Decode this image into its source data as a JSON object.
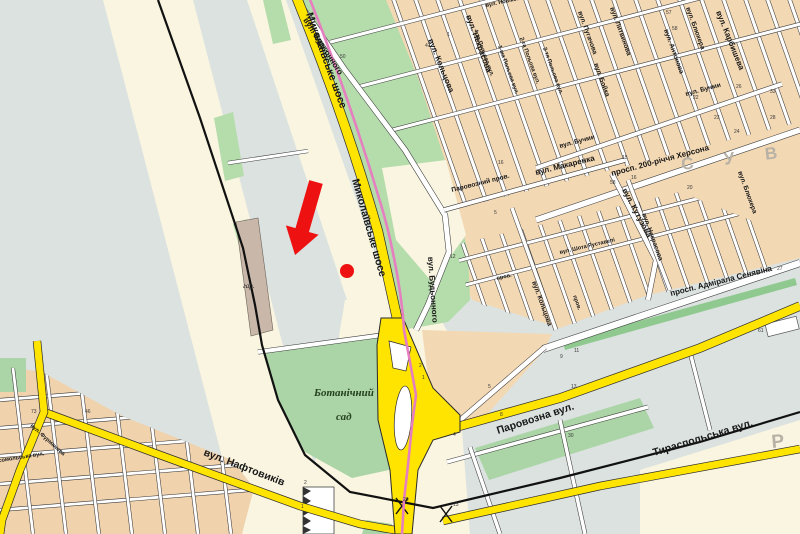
{
  "map": {
    "district_name_partial": "С У В О Р",
    "district_letter_bottom_right": "Р",
    "garden_name": [
      "Ботанічний",
      "сад"
    ],
    "marker": {
      "shape": "red-arrow-with-dot",
      "color": "#ee1111",
      "target": "Миколаївське шосе"
    },
    "colors": {
      "land_gray": "#dbe2e0",
      "land_cream": "#f9f5e0",
      "blocks_peach": "#f3d8b4",
      "park_green": "#b5dcab",
      "garden_green": "#abd5a6",
      "strip_green": "#8fc98f",
      "industrial_brown": "#c9b7aa",
      "road_yellow": "#ffe400",
      "route_pink": "#e57fc0",
      "railway_black": "#111111",
      "marker_red": "#ee1111"
    },
    "labels": [
      {
        "t": "Миколаївське шосе",
        "x": 306,
        "y": 14,
        "r": 70,
        "c": "rb"
      },
      {
        "t": "Миколаївське шосе",
        "x": 352,
        "y": 180,
        "r": 74,
        "c": "rb"
      },
      {
        "t": "Паровозна вул.",
        "x": 498,
        "y": 434,
        "r": -18,
        "c": "rb"
      },
      {
        "t": "Тираспольська вул.",
        "x": 654,
        "y": 456,
        "r": -17,
        "c": "rb"
      },
      {
        "t": "вул. Нафтовиків",
        "x": 203,
        "y": 455,
        "r": 21,
        "c": "rb"
      },
      {
        "t": "вул. Будьонного",
        "x": 303,
        "y": 20,
        "r": 57,
        "c": "md"
      },
      {
        "t": "вул. Будьонного",
        "x": 428,
        "y": 257,
        "r": 86,
        "c": "md"
      },
      {
        "t": "просп. Адмірала Сенявіна",
        "x": 671,
        "y": 296,
        "r": -14,
        "c": "md"
      },
      {
        "t": "просп. 200-річчя Херсона",
        "x": 612,
        "y": 176,
        "r": -15,
        "c": "md"
      },
      {
        "t": "вул. Карбишева",
        "x": 716,
        "y": 12,
        "r": 68,
        "c": "md"
      },
      {
        "t": "вул. Кутузова",
        "x": 622,
        "y": 190,
        "r": 62,
        "c": "md"
      },
      {
        "t": "вул. Макаренка",
        "x": 536,
        "y": 175,
        "r": -14,
        "c": "md"
      },
      {
        "t": "вул. Некрасова",
        "x": 466,
        "y": 16,
        "r": 70,
        "c": "md"
      },
      {
        "t": "вул. Некрасова",
        "x": 642,
        "y": 214,
        "r": 70,
        "c": "st"
      },
      {
        "t": "вул. Кольцова",
        "x": 428,
        "y": 40,
        "r": 68,
        "c": "md"
      },
      {
        "t": "вул. Кольцова",
        "x": 532,
        "y": 282,
        "r": 70,
        "c": "st"
      },
      {
        "t": "вул. Бойка",
        "x": 594,
        "y": 64,
        "r": 70,
        "c": "st"
      },
      {
        "t": "вул. Блюхера",
        "x": 686,
        "y": 8,
        "r": 70,
        "c": "st"
      },
      {
        "t": "вул. Блюхера",
        "x": 738,
        "y": 172,
        "r": 70,
        "c": "st"
      },
      {
        "t": "вул. Антонова",
        "x": 664,
        "y": 30,
        "r": 70,
        "c": "st"
      },
      {
        "t": "вул. Бучми",
        "x": 686,
        "y": 96,
        "r": -15,
        "c": "st"
      },
      {
        "t": "вул. Бучми",
        "x": 560,
        "y": 148,
        "r": -15,
        "c": "st"
      },
      {
        "t": "4-та Польова вул.",
        "x": 474,
        "y": 30,
        "r": 70,
        "c": "sm"
      },
      {
        "t": "1-ша Польова вул.",
        "x": 498,
        "y": 46,
        "r": 70,
        "c": "sm"
      },
      {
        "t": "2-га Польова вул.",
        "x": 520,
        "y": 38,
        "r": 70,
        "c": "sm"
      },
      {
        "t": "3-тя Польова вул.",
        "x": 543,
        "y": 48,
        "r": 70,
        "c": "sm"
      },
      {
        "t": "вул. Пугачова",
        "x": 578,
        "y": 12,
        "r": 70,
        "c": "st"
      },
      {
        "t": "вул. Литвинова",
        "x": 610,
        "y": 8,
        "r": 70,
        "c": "st"
      },
      {
        "t": "вул. Новікова",
        "x": 486,
        "y": 7,
        "r": -12,
        "c": "sm"
      },
      {
        "t": "Паровозний пров.",
        "x": 452,
        "y": 192,
        "r": -14,
        "c": "st"
      },
      {
        "t": "вул. Шота Руставелі",
        "x": 560,
        "y": 254,
        "r": -13,
        "c": "sm"
      },
      {
        "t": "пров.",
        "x": 497,
        "y": 280,
        "r": -13,
        "c": "sm"
      },
      {
        "t": "пров.",
        "x": 573,
        "y": 296,
        "r": 70,
        "c": "sm"
      },
      {
        "t": "Комсомольська вул.",
        "x": -12,
        "y": 464,
        "r": -9,
        "c": "sm"
      },
      {
        "t": "вул. Фурманова",
        "x": 30,
        "y": 426,
        "r": 42,
        "c": "sm"
      },
      {
        "t": "Ботанічний",
        "x": 314,
        "y": 396,
        "r": 0,
        "c": "gard"
      },
      {
        "t": "сад",
        "x": 336,
        "y": 420,
        "r": 0,
        "c": "gard"
      },
      {
        "t": "гар.",
        "x": 243,
        "y": 288,
        "r": 0,
        "c": "gari"
      },
      {
        "t": "С У В О Р",
        "x": 682,
        "y": 170,
        "r": -7,
        "c": "dist"
      },
      {
        "t": "Р",
        "x": 772,
        "y": 448,
        "r": -5,
        "c": "dist2"
      }
    ],
    "house_numbers": [
      {
        "t": "50",
        "x": 340,
        "y": 58
      },
      {
        "t": "47",
        "x": 425,
        "y": 47
      },
      {
        "t": "1",
        "x": 447,
        "y": 36
      },
      {
        "t": "12",
        "x": 450,
        "y": 258
      },
      {
        "t": "16",
        "x": 498,
        "y": 164
      },
      {
        "t": "5",
        "x": 494,
        "y": 214
      },
      {
        "t": "57",
        "x": 666,
        "y": 14
      },
      {
        "t": "58",
        "x": 672,
        "y": 30
      },
      {
        "t": "26",
        "x": 736,
        "y": 88
      },
      {
        "t": "33",
        "x": 770,
        "y": 93
      },
      {
        "t": "22",
        "x": 693,
        "y": 99
      },
      {
        "t": "23",
        "x": 714,
        "y": 119
      },
      {
        "t": "24",
        "x": 734,
        "y": 133
      },
      {
        "t": "28",
        "x": 770,
        "y": 119
      },
      {
        "t": "61",
        "x": 758,
        "y": 332
      },
      {
        "t": "27",
        "x": 777,
        "y": 270
      },
      {
        "t": "15",
        "x": 622,
        "y": 159
      },
      {
        "t": "16",
        "x": 631,
        "y": 179
      },
      {
        "t": "20",
        "x": 687,
        "y": 189
      },
      {
        "t": "58",
        "x": 610,
        "y": 184
      },
      {
        "t": "11",
        "x": 574,
        "y": 352
      },
      {
        "t": "9",
        "x": 560,
        "y": 358
      },
      {
        "t": "13",
        "x": 571,
        "y": 388
      },
      {
        "t": "5",
        "x": 488,
        "y": 388
      },
      {
        "t": "8",
        "x": 500,
        "y": 416
      },
      {
        "t": "4",
        "x": 453,
        "y": 436
      },
      {
        "t": "30",
        "x": 568,
        "y": 437
      },
      {
        "t": "2",
        "x": 304,
        "y": 484
      },
      {
        "t": "1",
        "x": 301,
        "y": 508
      },
      {
        "t": "26",
        "x": 403,
        "y": 501
      },
      {
        "t": "13",
        "x": 453,
        "y": 506
      },
      {
        "t": "73",
        "x": 31,
        "y": 413
      },
      {
        "t": "46",
        "x": 85,
        "y": 413
      },
      {
        "t": "2",
        "x": 419,
        "y": 367
      },
      {
        "t": "1",
        "x": 422,
        "y": 379
      }
    ]
  }
}
